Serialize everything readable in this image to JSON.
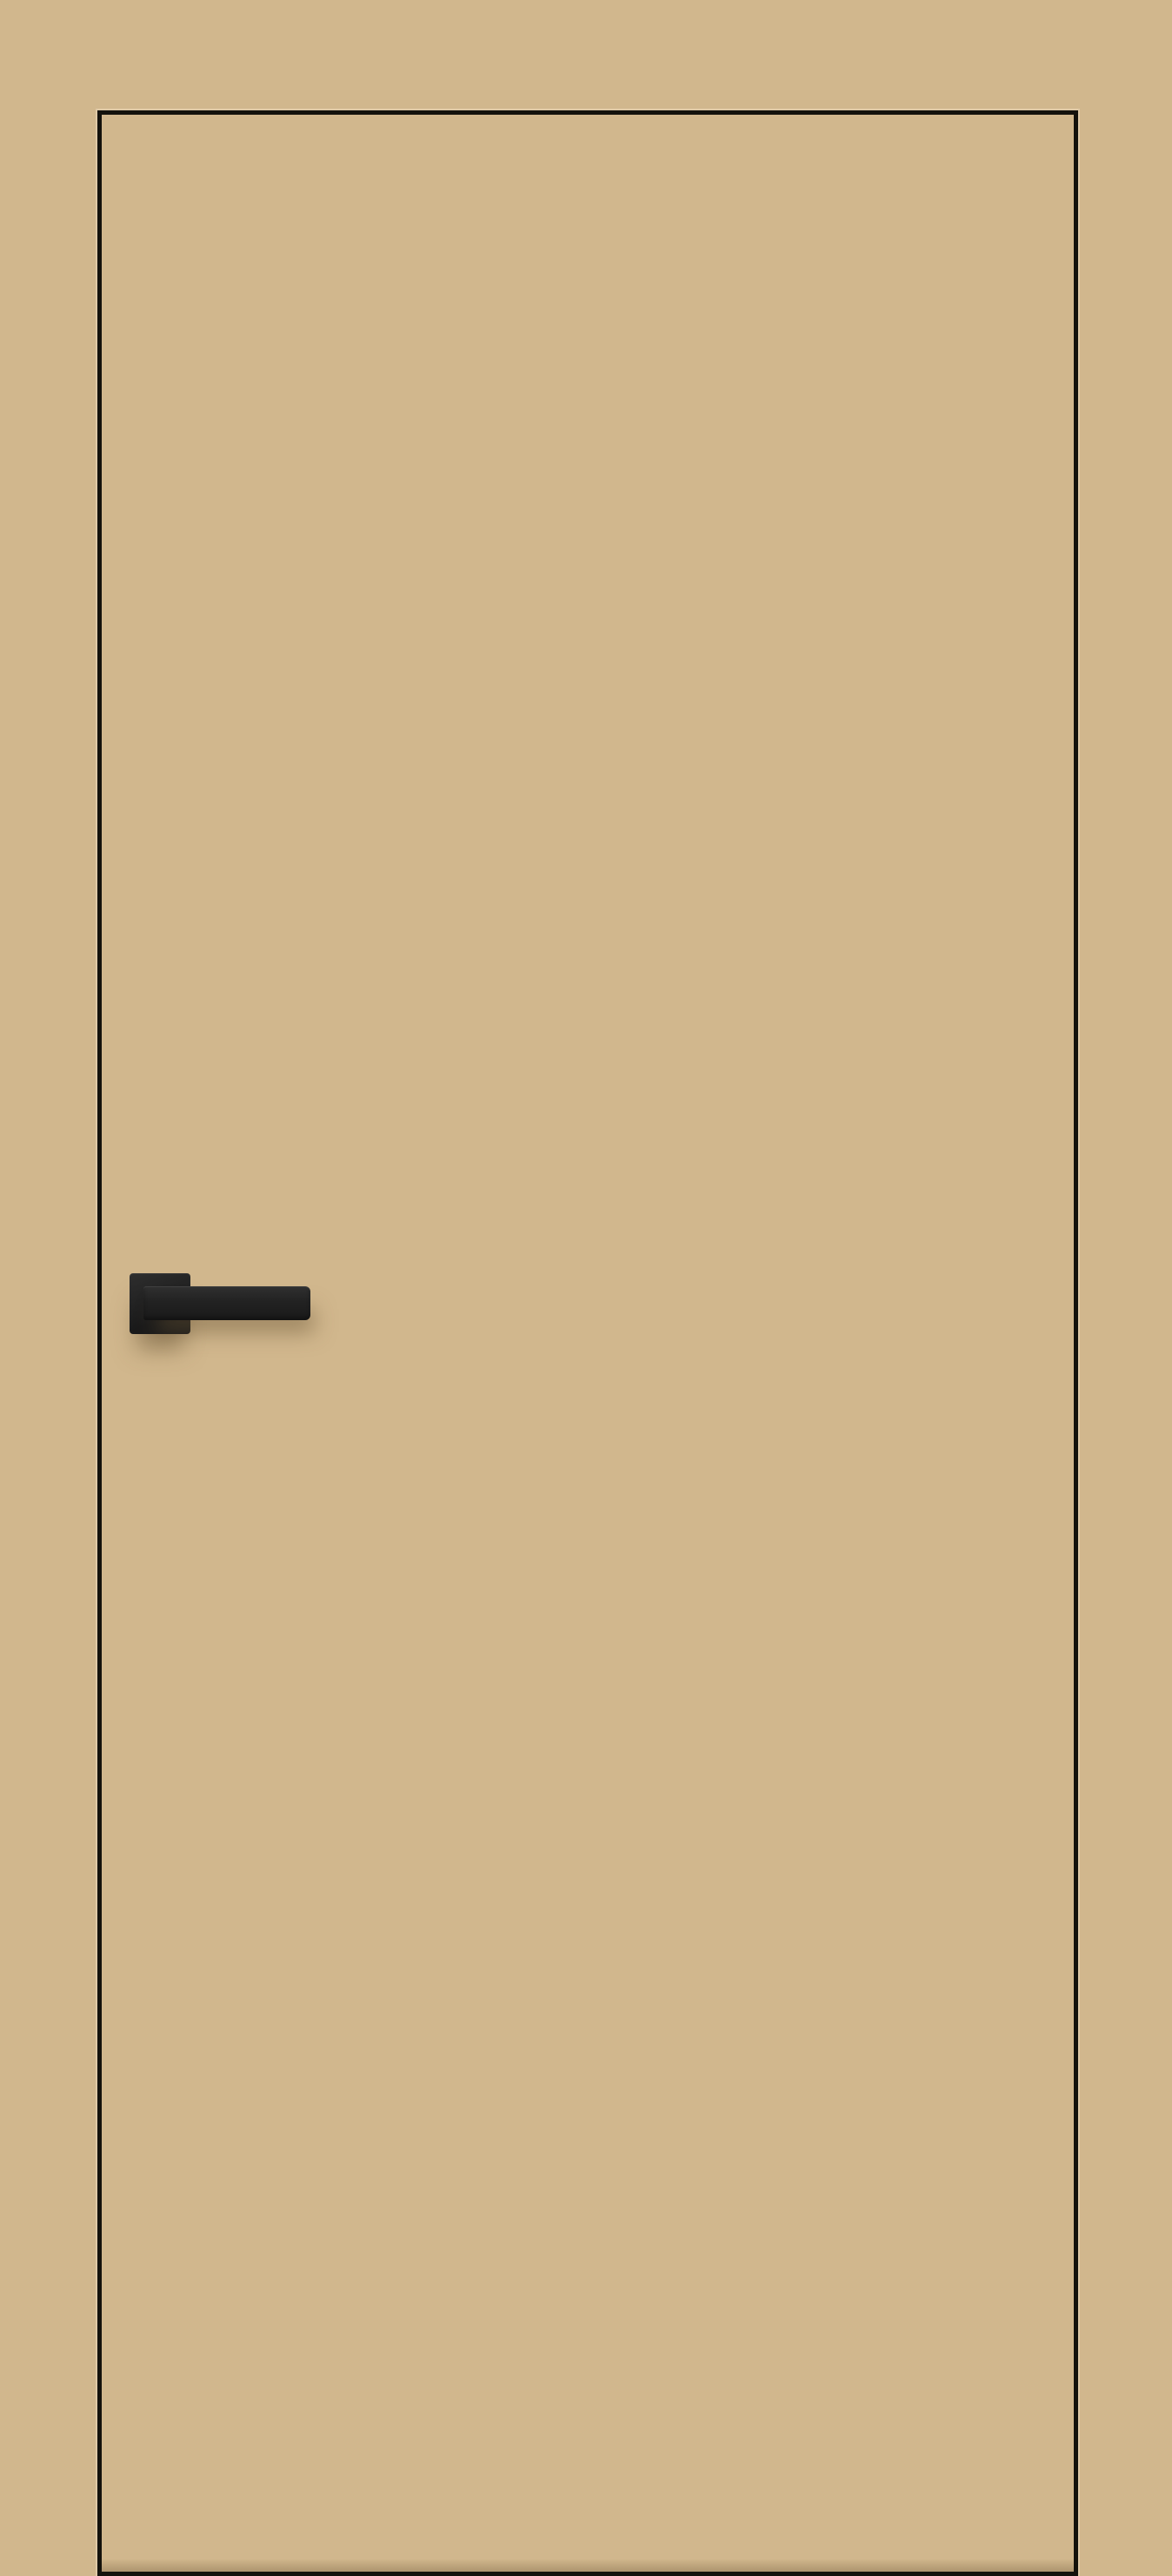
{
  "scene": {
    "subject": "flush frameless interior door with concealed frame, painted the same beige as the surrounding wall",
    "door_outline": "thin dark reveal line around the door leaf, running to the bottom edge of the image",
    "handle": "matte black square-rosette straight lever handle mounted on the left side at mid height",
    "shadows": "soft diffuse shadow cast below the handle and a faint shade above the door bottom edge",
    "colors": {
      "wall": "#d1b78d",
      "door": "#d1b78d",
      "outline": "#14120c",
      "edge_light": "rgba(255,246,224,0.30)",
      "handle_dark": "#1a1a1a",
      "handle_mid": "#2e2e2e",
      "soft_shadow": "rgba(104,84,52,0.50)"
    }
  }
}
